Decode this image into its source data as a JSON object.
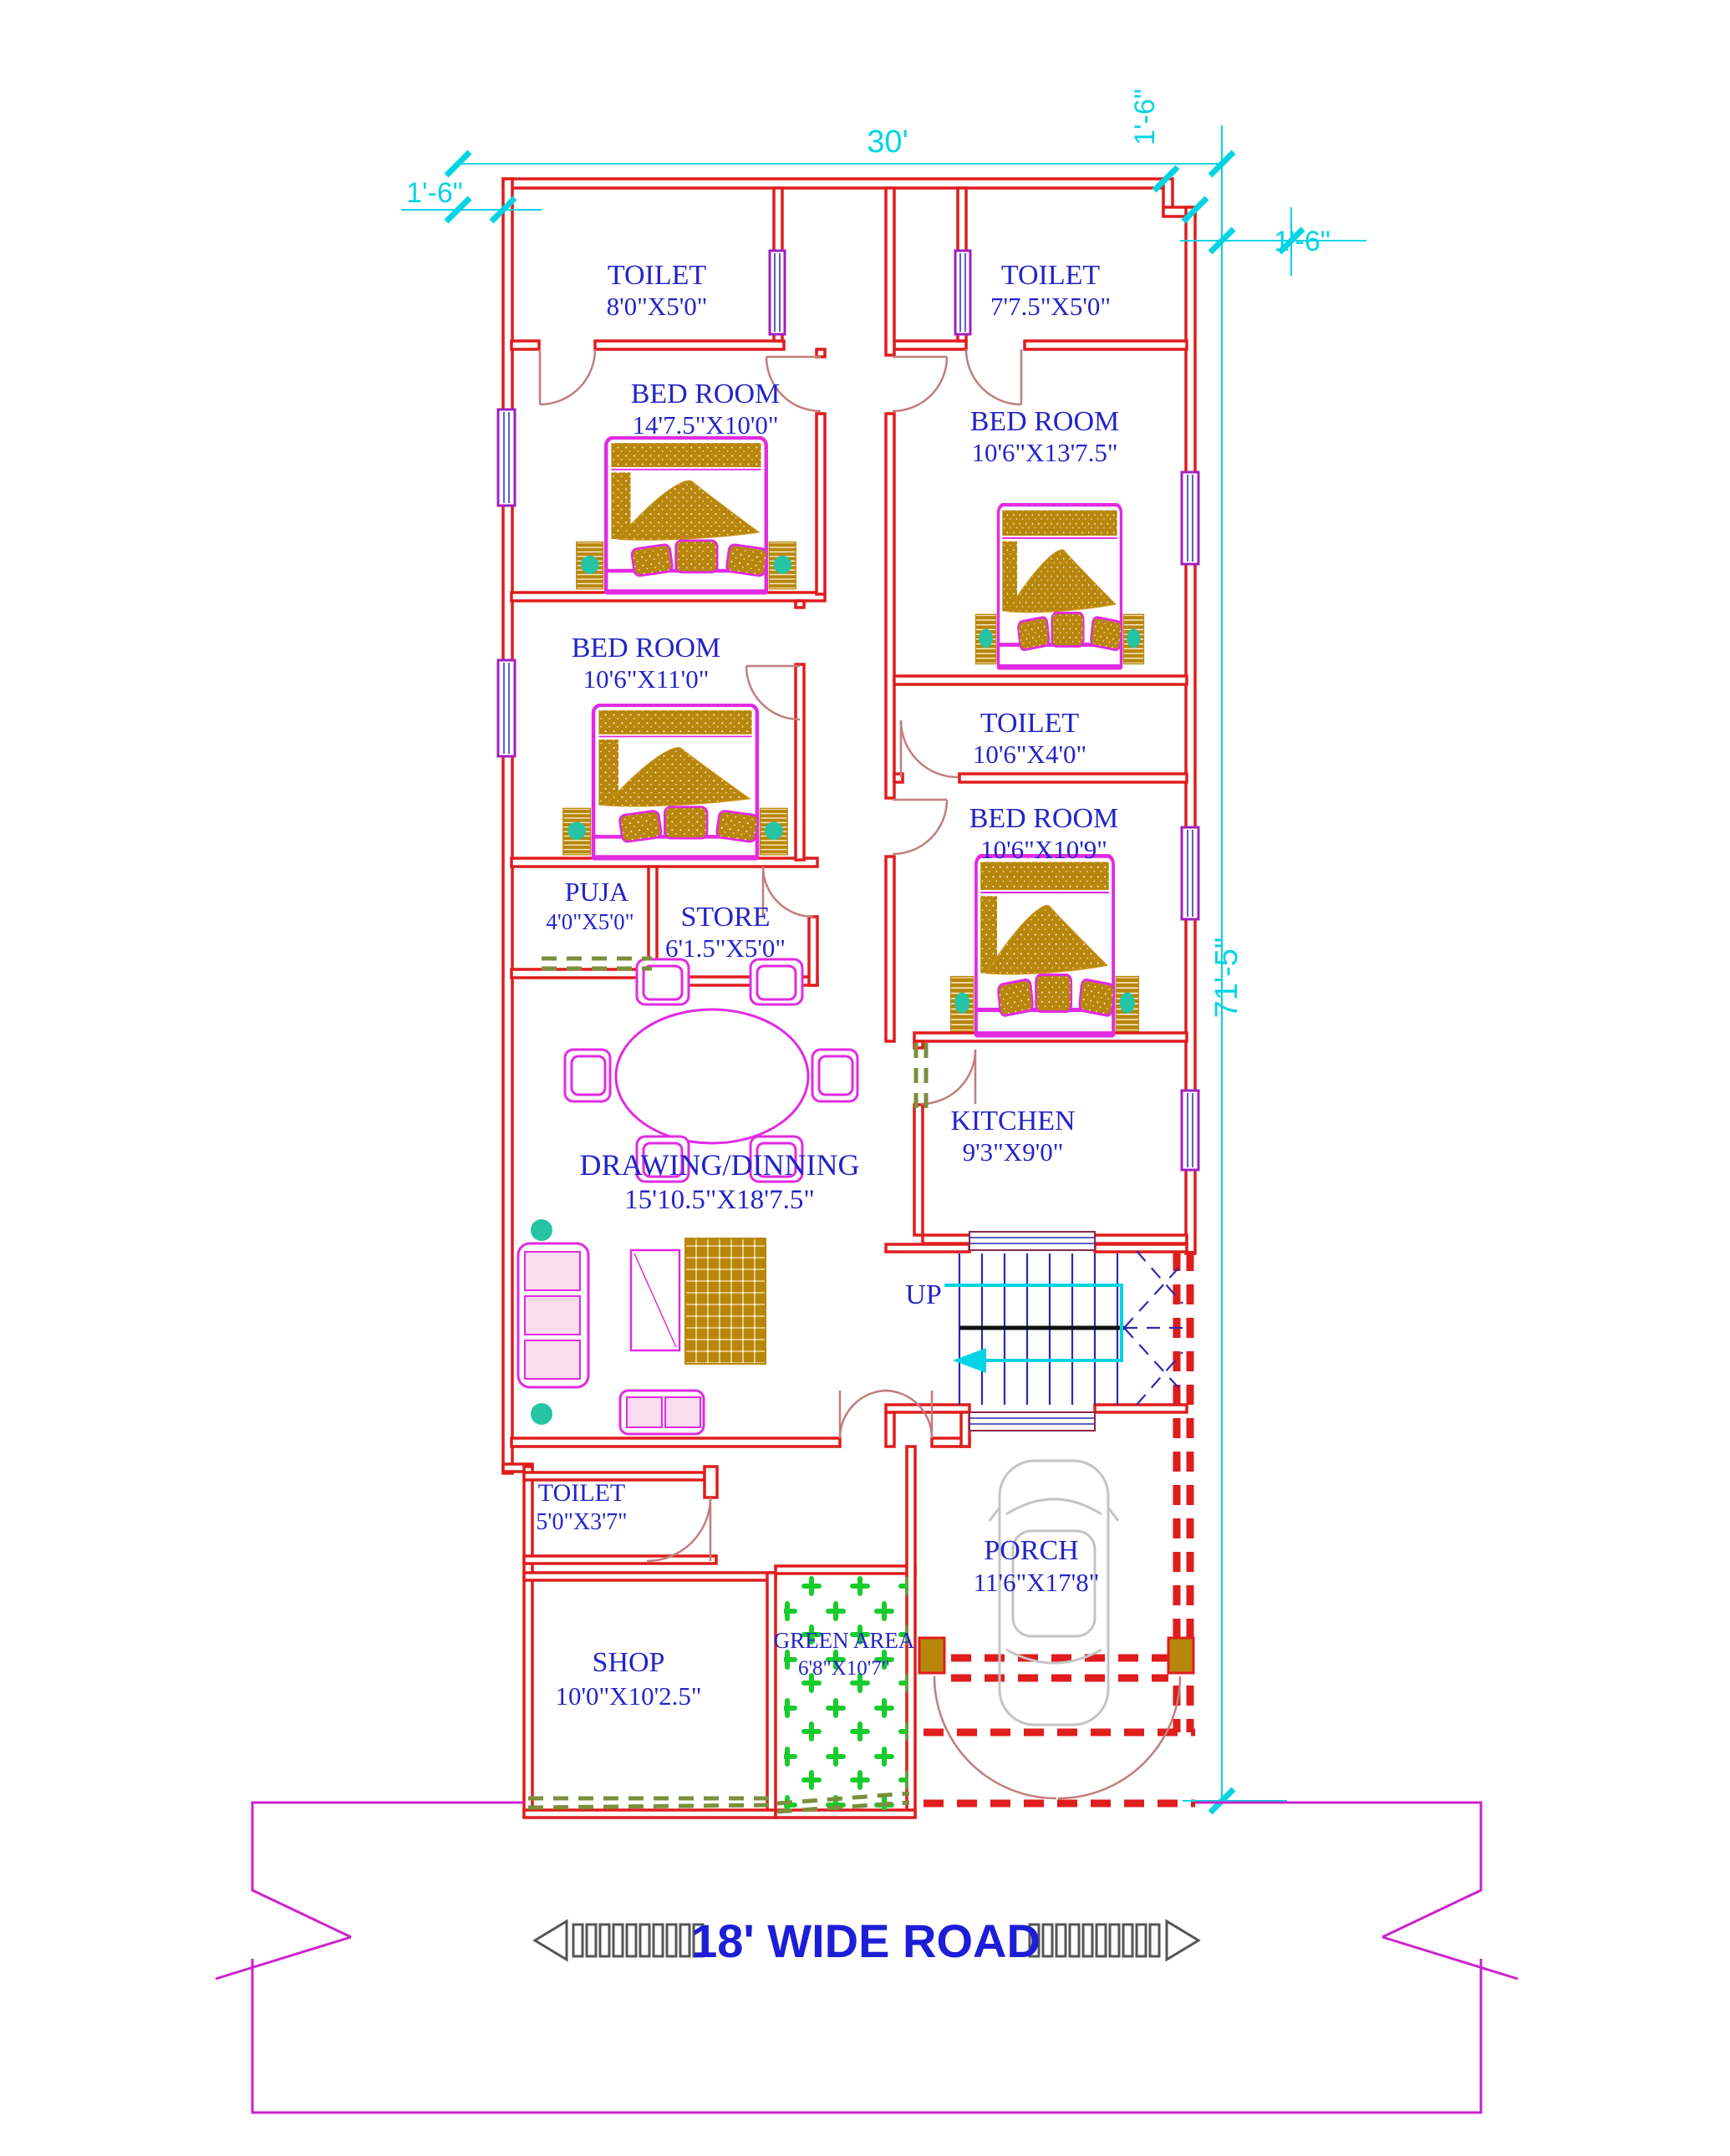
{
  "dimensions": {
    "top_width": "30'",
    "top_left_offset": "1'-6\"",
    "top_right_offset": "1'-6\"",
    "right_offset": "1'-6\"",
    "right_height": "71'-5\""
  },
  "rooms": {
    "toilet_top_left": {
      "name": "TOILET",
      "size": "8'0\"X5'0\""
    },
    "toilet_top_right": {
      "name": "TOILET",
      "size": "7'7.5\"X5'0\""
    },
    "bedroom_top_left": {
      "name": "BED ROOM",
      "size": "14'7.5\"X10'0\""
    },
    "bedroom_top_right": {
      "name": "BED ROOM",
      "size": "10'6\"X13'7.5\""
    },
    "bedroom_mid_left": {
      "name": "BED ROOM",
      "size": "10'6\"X11'0\""
    },
    "toilet_mid_right": {
      "name": "TOILET",
      "size": "10'6\"X4'0\""
    },
    "bedroom_mid_right": {
      "name": "BED ROOM",
      "size": "10'6\"X10'9\""
    },
    "puja": {
      "name": "PUJA",
      "size": "4'0\"X5'0\""
    },
    "store": {
      "name": "STORE",
      "size": "6'1.5\"X5'0\""
    },
    "kitchen": {
      "name": "KITCHEN",
      "size": "9'3\"X9'0\""
    },
    "drawing_dining": {
      "name": "DRAWING/DINNING",
      "size": "15'10.5\"X18'7.5\""
    },
    "toilet_bottom": {
      "name": "TOILET",
      "size": "5'0\"X3'7\""
    },
    "shop": {
      "name": "SHOP",
      "size": "10'0\"X10'2.5\""
    },
    "green_area": {
      "name": "GREEN AREA",
      "size": "6'8\"X10'7\""
    },
    "porch": {
      "name": "PORCH",
      "size": "11'6\"X17'8\""
    }
  },
  "stairs": {
    "up_label": "UP"
  },
  "road": {
    "label": "18' WIDE ROAD"
  },
  "colors": {
    "wall_red": "#e01c1c",
    "label_blue": "#2424c8",
    "dimension_cyan": "#00d4e4",
    "furniture_magenta": "#e22ae2",
    "wood_gold": "#b8860b",
    "green_area_green": "#18cc2c",
    "banner_magenta": "#cc22cc",
    "olive_dash": "#7b8f3c"
  }
}
